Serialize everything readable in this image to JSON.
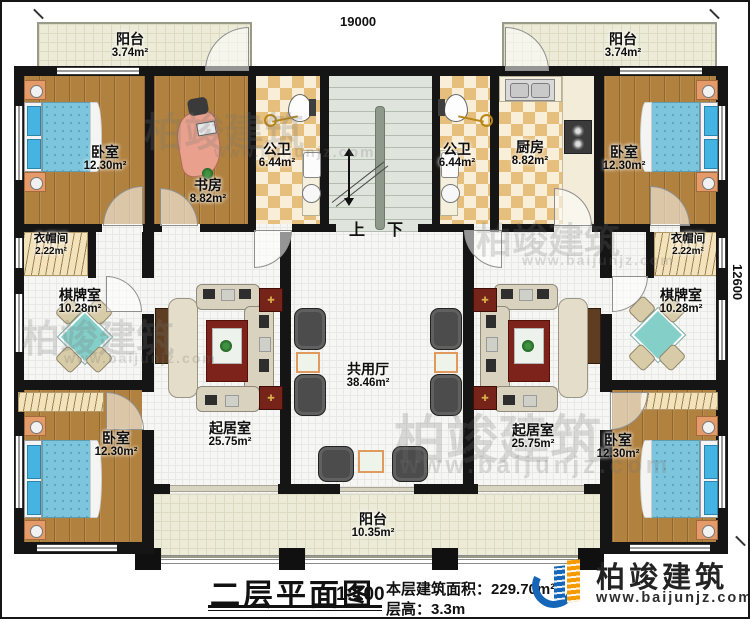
{
  "dimensions": {
    "top": "19000",
    "right": "12600"
  },
  "stairs": {
    "up": "上",
    "down": "下"
  },
  "rooms": {
    "balcony_tl": {
      "name": "阳台",
      "area": "3.74m²"
    },
    "balcony_tr": {
      "name": "阳台",
      "area": "3.74m²"
    },
    "bedroom_tl": {
      "name": "卧室",
      "area": "12.30m²"
    },
    "study": {
      "name": "书房",
      "area": "8.82m²"
    },
    "bath_l": {
      "name": "公卫",
      "area": "6.44m²"
    },
    "bath_r": {
      "name": "公卫",
      "area": "6.44m²"
    },
    "kitchen": {
      "name": "厨房",
      "area": "8.82m²"
    },
    "bedroom_tr": {
      "name": "卧室",
      "area": "12.30m²"
    },
    "cloak_l": {
      "name": "衣帽间",
      "area": "2.22m²"
    },
    "cloak_r": {
      "name": "衣帽间",
      "area": "2.22m²"
    },
    "chess_l": {
      "name": "棋牌室",
      "area": "10.28m²"
    },
    "chess_r": {
      "name": "棋牌室",
      "area": "10.28m²"
    },
    "shared_hall": {
      "name": "共用厅",
      "area": "38.46m²"
    },
    "living_l": {
      "name": "起居室",
      "area": "25.75m²"
    },
    "living_r": {
      "name": "起居室",
      "area": "25.75m²"
    },
    "bedroom_bl": {
      "name": "卧室",
      "area": "12.30m²"
    },
    "bedroom_br": {
      "name": "卧室",
      "area": "12.30m²"
    },
    "balcony_b": {
      "name": "阳台",
      "area": "10.35m²"
    }
  },
  "title_block": {
    "title": "二层平面图",
    "scale": "1:100",
    "floor_area_label": "本层建筑面积：",
    "floor_area_value": "229.70m²",
    "floor_height_label": "层高：",
    "floor_height_value": "3.3m"
  },
  "branding": {
    "company": "柏竣建筑",
    "website": "www.baijunjz.com"
  },
  "watermark": {
    "text": "柏竣建筑",
    "subtext": "www.baijunjz.com"
  },
  "colors": {
    "wall": "#151515",
    "wood_floor": "#b0813f",
    "tile": "#e7bf7d",
    "balcony": "#ecebd8",
    "stair": "#dfe5dc",
    "bed_blue": "#7cc5dc",
    "logo_blue": "#1565b8",
    "logo_orange": "#f59b00"
  }
}
